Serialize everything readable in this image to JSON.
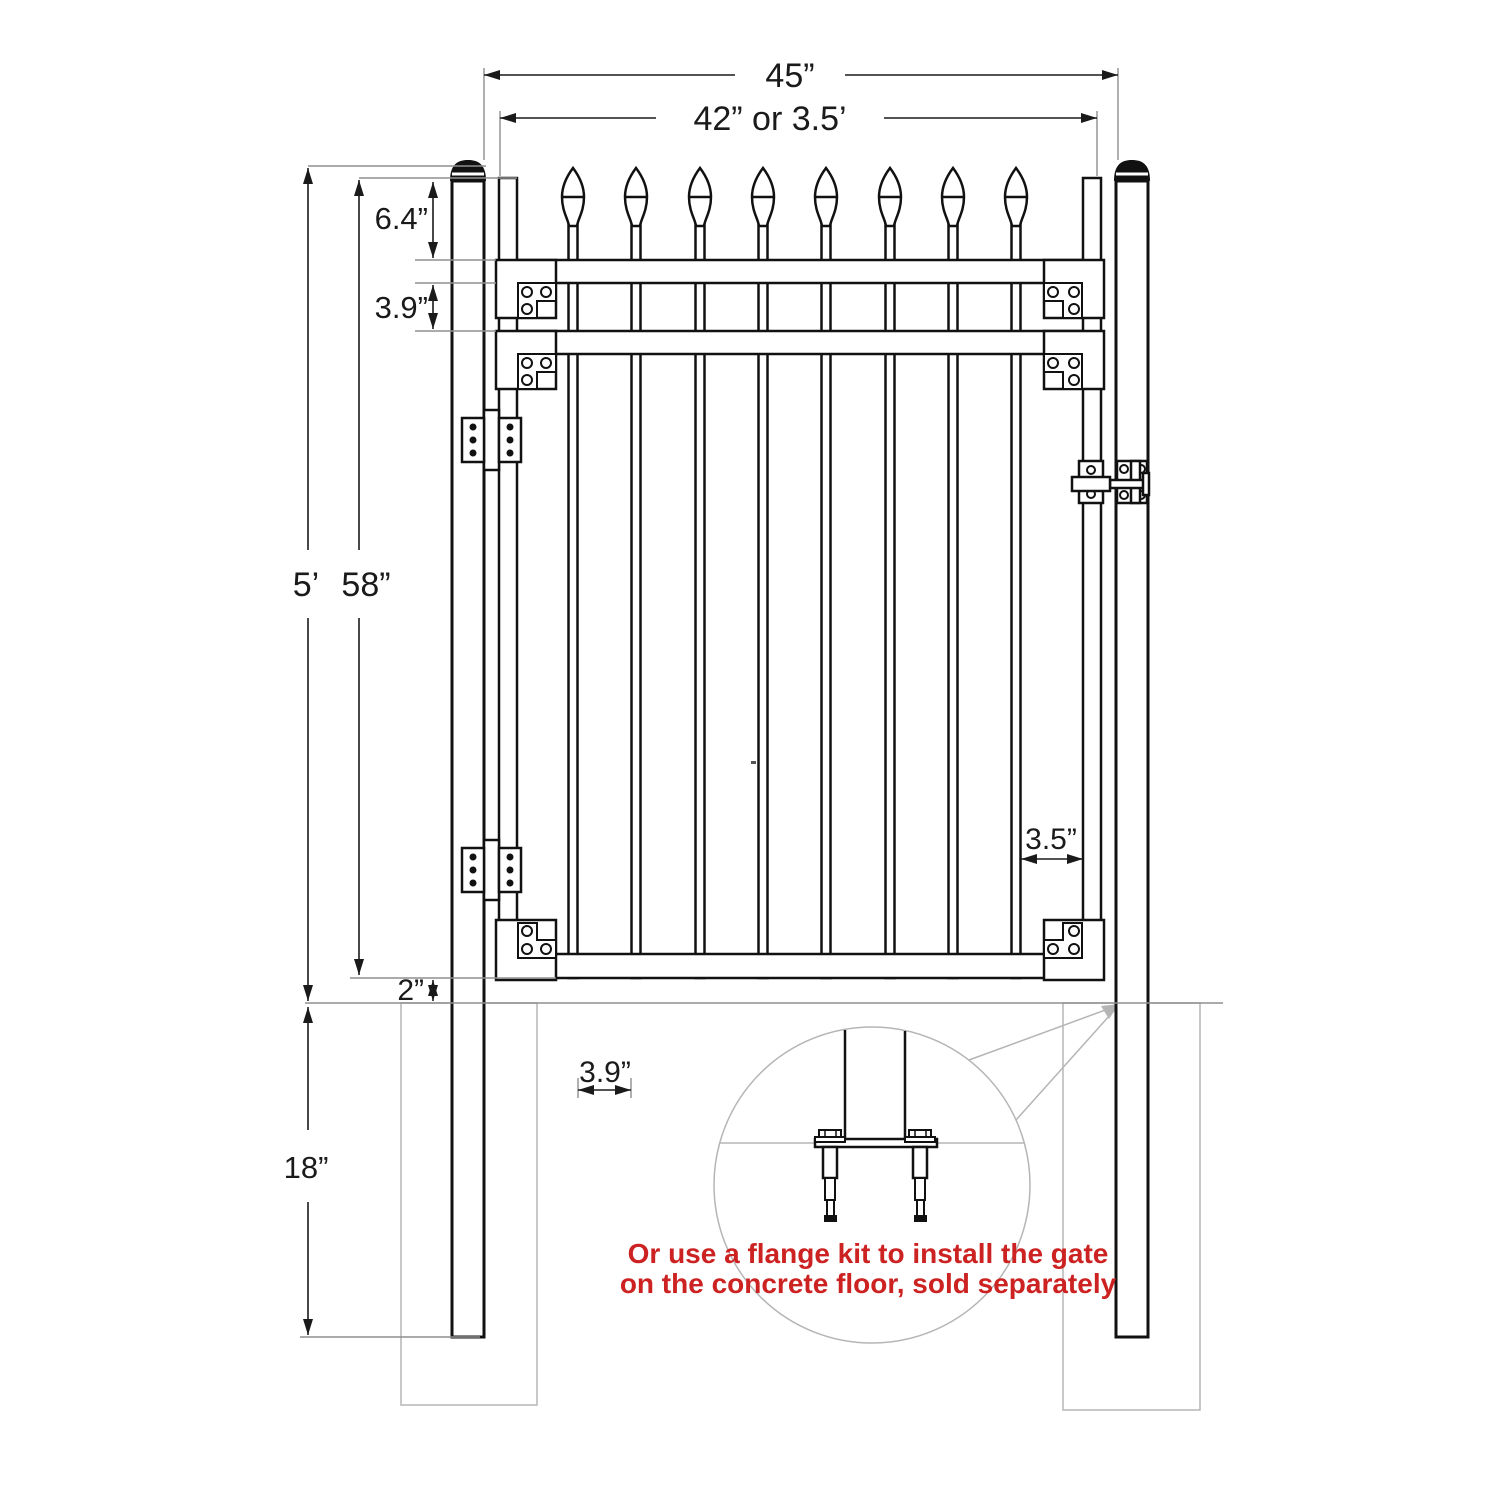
{
  "diagram_title": "Single gate installation drawing",
  "dimensions": {
    "overall_width": "45”",
    "gate_width": "42” or 3.5’",
    "post_above_ground_height": "5’",
    "gate_height": "58”",
    "finial_to_rail": "6.4”",
    "rail_spacing": "3.9”",
    "ground_clearance": "2”",
    "post_buried_depth": "18”",
    "picket_spacing": "3.9”",
    "picket_to_frame": "3.5”"
  },
  "callout_note": {
    "line1": "Or use a flange kit to install the gate",
    "line2": "on the concrete floor, sold separately",
    "color": "#cc2222"
  },
  "colors": {
    "line": "#111111",
    "dimension": "#1a1a1a",
    "light_gray": "#b5b5b5",
    "extension_gray": "#8f8f8f",
    "note_red": "#cc2222"
  }
}
